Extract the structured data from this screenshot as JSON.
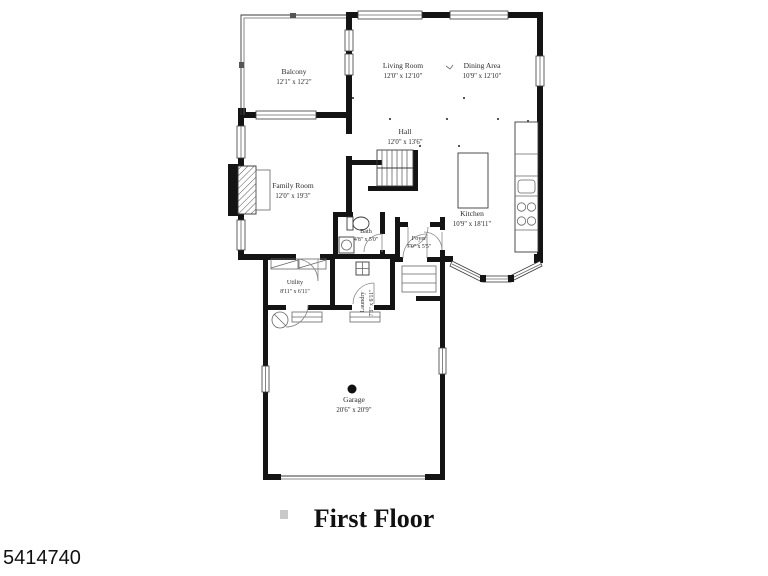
{
  "floorplan": {
    "title": "First Floor",
    "listing_id": "5414740",
    "rooms": {
      "balcony": {
        "name": "Balcony",
        "dims": "12'1\" x 12'2\""
      },
      "living_room": {
        "name": "Living Room",
        "dims": "12'0\" x 12'10\""
      },
      "dining_area": {
        "name": "Dining Area",
        "dims": "10'9\" x 12'10\""
      },
      "hall": {
        "name": "Hall",
        "dims": "12'0\" x 13'6\""
      },
      "family_room": {
        "name": "Family Room",
        "dims": "12'0\" x 19'3\""
      },
      "kitchen": {
        "name": "Kitchen",
        "dims": "10'9\" x 18'11\""
      },
      "bath": {
        "name": "Bath",
        "dims": "4'8\" x 5'0\""
      },
      "foyer": {
        "name": "Foyer",
        "dims": "7'0\" x 5'5\""
      },
      "utility": {
        "name": "Utility",
        "dims": "8'11\" x 6'11\""
      },
      "laundry": {
        "name": "Laundry",
        "dims": "7'3\" x 6'11\""
      },
      "garage": {
        "name": "Garage",
        "dims": "20'6\" x 20'9\""
      }
    },
    "colors": {
      "wall": "#141414",
      "line": "#3a3a3a",
      "text": "#2b2b2b",
      "background": "#ffffff"
    }
  }
}
